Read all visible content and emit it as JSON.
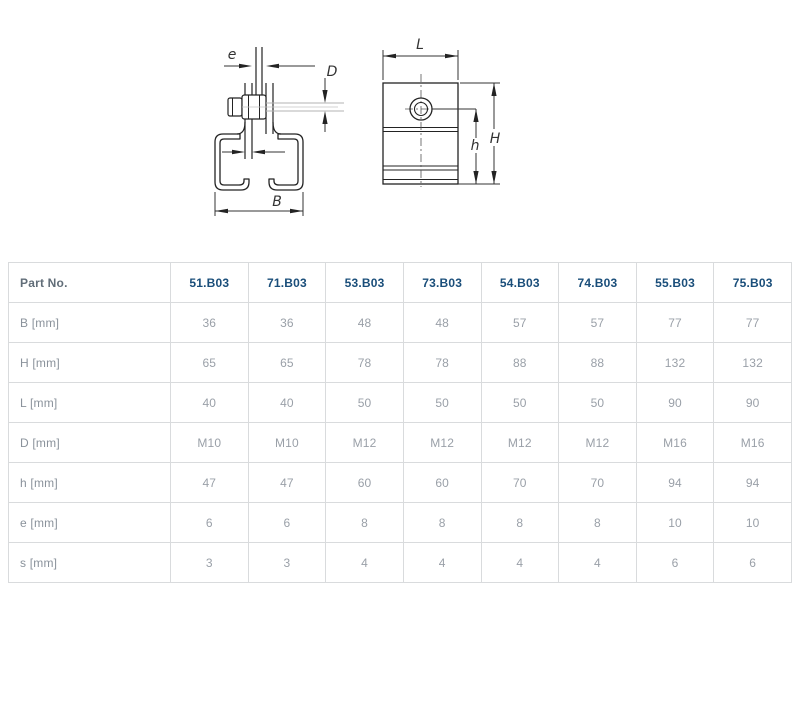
{
  "diagram": {
    "labels": {
      "e": "e",
      "D": "D",
      "B": "B",
      "s": "s",
      "L": "L",
      "H": "H",
      "h": "h"
    },
    "views": {
      "front": "front-view-c-rail-with-hanger-bolt",
      "side": "side-view-with-bolt"
    }
  },
  "table": {
    "header": {
      "label": "Part No.",
      "columns": [
        "51.B03",
        "71.B03",
        "53.B03",
        "73.B03",
        "54.B03",
        "74.B03",
        "55.B03",
        "75.B03"
      ]
    },
    "rows": [
      {
        "label": "B [mm]",
        "values": [
          "36",
          "36",
          "48",
          "48",
          "57",
          "57",
          "77",
          "77"
        ]
      },
      {
        "label": "H [mm]",
        "values": [
          "65",
          "65",
          "78",
          "78",
          "88",
          "88",
          "132",
          "132"
        ]
      },
      {
        "label": "L [mm]",
        "values": [
          "40",
          "40",
          "50",
          "50",
          "50",
          "50",
          "90",
          "90"
        ]
      },
      {
        "label": "D [mm]",
        "values": [
          "M10",
          "M10",
          "M12",
          "M12",
          "M12",
          "M12",
          "M16",
          "M16"
        ]
      },
      {
        "label": "h [mm]",
        "values": [
          "47",
          "47",
          "60",
          "60",
          "70",
          "70",
          "94",
          "94"
        ]
      },
      {
        "label": "e [mm]",
        "values": [
          "6",
          "6",
          "8",
          "8",
          "8",
          "8",
          "10",
          "10"
        ]
      },
      {
        "label": "s [mm]",
        "values": [
          "3",
          "3",
          "4",
          "4",
          "4",
          "4",
          "6",
          "6"
        ]
      }
    ]
  },
  "colors": {
    "part_number_blue": "#1a4e7a",
    "header_label_gray": "#616d78",
    "value_gray": "#9aa0a8",
    "table_border": "#d9dbdd",
    "drawing_line": "#232323"
  }
}
